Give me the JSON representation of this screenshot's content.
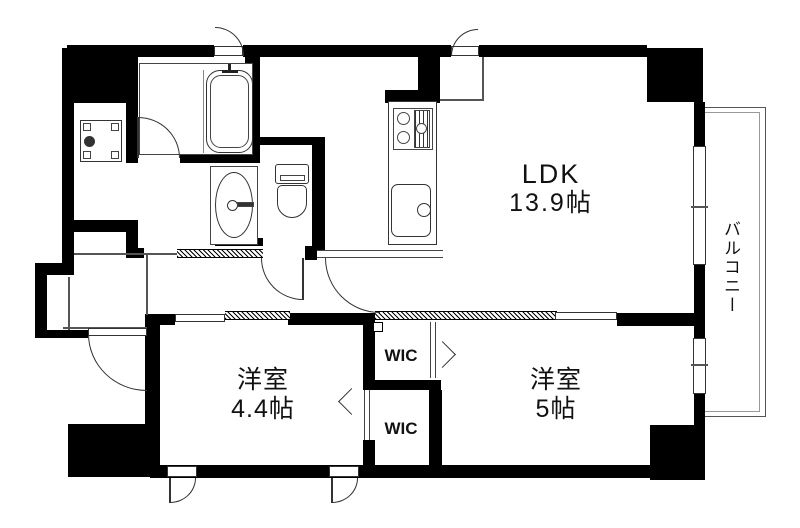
{
  "rooms": {
    "ldk": {
      "name": "LDK",
      "size": "13.9帖"
    },
    "bedroom_small": {
      "name": "洋室",
      "size": "4.4帖"
    },
    "bedroom_large": {
      "name": "洋室",
      "size": "5帖"
    },
    "wic_upper": {
      "name": "WIC"
    },
    "wic_lower": {
      "name": "WIC"
    },
    "balcony": {
      "name": "バルコニー"
    }
  },
  "colors": {
    "wall": "#000000",
    "line": "#555555",
    "background": "#ffffff"
  }
}
